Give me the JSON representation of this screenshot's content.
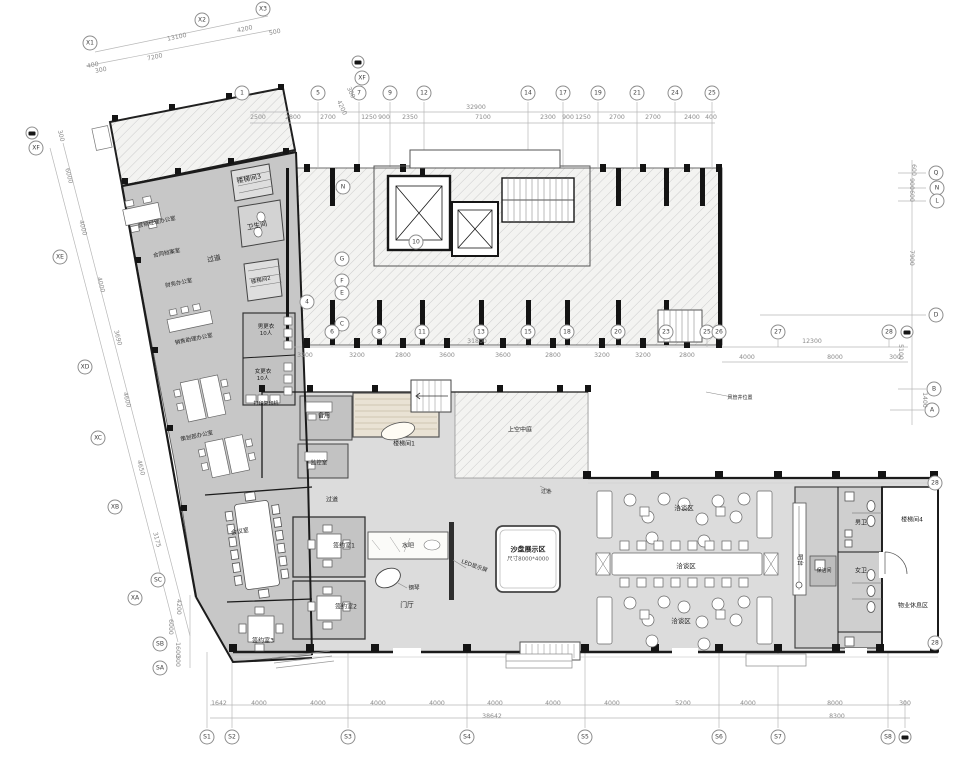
{
  "drawing_type": "architectural floor plan",
  "palette": {
    "wall": "#1b1b1b",
    "room_fill": "#c7c7c7",
    "hall_fill": "#dcdcdc",
    "hatch_line": "#bdbdbd",
    "dim_line": "#b8b8b8",
    "dim_text": "#8b8b8b",
    "label_text": "#232323"
  },
  "plan": {
    "key_labels": {
      "sandbox": "沙盘展示区",
      "sandbox_size": "尺寸8000*4000",
      "lobby": "门厅"
    },
    "grid_bubbles": [
      {
        "l": "X1",
        "x": 90,
        "y": 43
      },
      {
        "l": "X2",
        "x": 202,
        "y": 20
      },
      {
        "l": "X3",
        "x": 263,
        "y": 9
      },
      {
        "f": 1,
        "x": 358,
        "y": 62
      },
      {
        "l": "XF",
        "x": 362,
        "y": 78
      },
      {
        "l": "1",
        "x": 242,
        "y": 93
      },
      {
        "l": "5",
        "x": 318,
        "y": 93
      },
      {
        "l": "7",
        "x": 359,
        "y": 93
      },
      {
        "l": "9",
        "x": 390,
        "y": 93
      },
      {
        "l": "12",
        "x": 424,
        "y": 93
      },
      {
        "l": "14",
        "x": 528,
        "y": 93
      },
      {
        "l": "17",
        "x": 563,
        "y": 93
      },
      {
        "l": "19",
        "x": 598,
        "y": 93
      },
      {
        "l": "21",
        "x": 637,
        "y": 93
      },
      {
        "l": "24",
        "x": 675,
        "y": 93
      },
      {
        "l": "25",
        "x": 712,
        "y": 93
      },
      {
        "f": 1,
        "x": 32,
        "y": 133
      },
      {
        "l": "XF",
        "x": 36,
        "y": 148
      },
      {
        "l": "XE",
        "x": 60,
        "y": 257
      },
      {
        "l": "XD",
        "x": 85,
        "y": 367
      },
      {
        "l": "XC",
        "x": 98,
        "y": 438
      },
      {
        "l": "XB",
        "x": 115,
        "y": 507
      },
      {
        "l": "SC",
        "x": 158,
        "y": 580
      },
      {
        "l": "XA",
        "x": 135,
        "y": 598
      },
      {
        "l": "SB",
        "x": 160,
        "y": 644
      },
      {
        "l": "SA",
        "x": 160,
        "y": 668
      },
      {
        "l": "N",
        "x": 343,
        "y": 187
      },
      {
        "l": "G",
        "x": 342,
        "y": 259
      },
      {
        "l": "F",
        "x": 342,
        "y": 281
      },
      {
        "l": "E",
        "x": 342,
        "y": 293
      },
      {
        "l": "C",
        "x": 342,
        "y": 324
      },
      {
        "l": "4",
        "x": 307,
        "y": 302
      },
      {
        "l": "10",
        "x": 416,
        "y": 242
      },
      {
        "l": "6",
        "x": 332,
        "y": 332
      },
      {
        "l": "8",
        "x": 379,
        "y": 332
      },
      {
        "l": "11",
        "x": 422,
        "y": 332
      },
      {
        "l": "13",
        "x": 481,
        "y": 332
      },
      {
        "l": "15",
        "x": 528,
        "y": 332
      },
      {
        "l": "18",
        "x": 567,
        "y": 332
      },
      {
        "l": "20",
        "x": 618,
        "y": 332
      },
      {
        "l": "23",
        "x": 666,
        "y": 332
      },
      {
        "l": "25",
        "x": 707,
        "y": 332
      },
      {
        "l": "26",
        "x": 719,
        "y": 332
      },
      {
        "l": "27",
        "x": 778,
        "y": 332
      },
      {
        "l": "28",
        "x": 889,
        "y": 332
      },
      {
        "f": 1,
        "x": 907,
        "y": 332
      },
      {
        "l": "Q",
        "x": 936,
        "y": 173
      },
      {
        "l": "N",
        "x": 937,
        "y": 188
      },
      {
        "l": "L",
        "x": 937,
        "y": 201
      },
      {
        "l": "D",
        "x": 936,
        "y": 315
      },
      {
        "l": "B",
        "x": 934,
        "y": 389
      },
      {
        "l": "A",
        "x": 932,
        "y": 410
      },
      {
        "l": "28",
        "x": 935,
        "y": 483
      },
      {
        "l": "28",
        "x": 935,
        "y": 643
      },
      {
        "l": "S1",
        "x": 207,
        "y": 737
      },
      {
        "l": "S2",
        "x": 232,
        "y": 737
      },
      {
        "l": "S3",
        "x": 348,
        "y": 737
      },
      {
        "l": "S4",
        "x": 467,
        "y": 737
      },
      {
        "l": "S5",
        "x": 585,
        "y": 737
      },
      {
        "l": "S6",
        "x": 719,
        "y": 737
      },
      {
        "l": "S7",
        "x": 778,
        "y": 737
      },
      {
        "l": "S8",
        "x": 888,
        "y": 737
      },
      {
        "f": 1,
        "x": 905,
        "y": 737
      }
    ],
    "dimensions": [
      {
        "t": "7200",
        "x": 155,
        "y": 58,
        "r": -12
      },
      {
        "t": "13100",
        "x": 177,
        "y": 38,
        "r": -12
      },
      {
        "t": "4200",
        "x": 245,
        "y": 30,
        "r": -12
      },
      {
        "t": "500",
        "x": 275,
        "y": 33,
        "r": -12
      },
      {
        "t": "400",
        "x": 93,
        "y": 66,
        "r": -12
      },
      {
        "t": "300",
        "x": 101,
        "y": 71,
        "r": -12
      },
      {
        "t": "4200",
        "x": 341,
        "y": 108,
        "r": 65
      },
      {
        "t": "300",
        "x": 350,
        "y": 93,
        "r": 65
      },
      {
        "t": "32900",
        "x": 476,
        "y": 108
      },
      {
        "t": "2500",
        "x": 258,
        "y": 118
      },
      {
        "t": "2800",
        "x": 293,
        "y": 118
      },
      {
        "t": "2700",
        "x": 328,
        "y": 118
      },
      {
        "t": "1250",
        "x": 369,
        "y": 118
      },
      {
        "t": "900",
        "x": 384,
        "y": 118
      },
      {
        "t": "2350",
        "x": 410,
        "y": 118
      },
      {
        "t": "7100",
        "x": 483,
        "y": 118
      },
      {
        "t": "2300",
        "x": 548,
        "y": 118
      },
      {
        "t": "900",
        "x": 568,
        "y": 118
      },
      {
        "t": "1250",
        "x": 583,
        "y": 118
      },
      {
        "t": "2700",
        "x": 617,
        "y": 118
      },
      {
        "t": "2700",
        "x": 653,
        "y": 118
      },
      {
        "t": "2400",
        "x": 692,
        "y": 118
      },
      {
        "t": "400",
        "x": 711,
        "y": 118
      },
      {
        "t": "31800",
        "x": 477,
        "y": 342
      },
      {
        "t": "3200",
        "x": 305,
        "y": 356
      },
      {
        "t": "3200",
        "x": 357,
        "y": 356
      },
      {
        "t": "2800",
        "x": 403,
        "y": 356
      },
      {
        "t": "3600",
        "x": 447,
        "y": 356
      },
      {
        "t": "3600",
        "x": 503,
        "y": 356
      },
      {
        "t": "2800",
        "x": 553,
        "y": 356
      },
      {
        "t": "3200",
        "x": 602,
        "y": 356
      },
      {
        "t": "3200",
        "x": 643,
        "y": 356
      },
      {
        "t": "2800",
        "x": 687,
        "y": 356
      },
      {
        "t": "12300",
        "x": 812,
        "y": 342
      },
      {
        "t": "4000",
        "x": 747,
        "y": 358
      },
      {
        "t": "8000",
        "x": 835,
        "y": 358
      },
      {
        "t": "300",
        "x": 895,
        "y": 358
      },
      {
        "t": "600",
        "x": 913,
        "y": 170,
        "r": 90
      },
      {
        "t": "900",
        "x": 911,
        "y": 184,
        "r": 90
      },
      {
        "t": "600",
        "x": 911,
        "y": 196,
        "r": 90
      },
      {
        "t": "7900",
        "x": 911,
        "y": 258,
        "r": 90
      },
      {
        "t": "5100",
        "x": 900,
        "y": 352,
        "r": 90
      },
      {
        "t": "1400",
        "x": 924,
        "y": 400,
        "r": 90
      },
      {
        "t": "300",
        "x": 60,
        "y": 136,
        "r": 76
      },
      {
        "t": "6000",
        "x": 68,
        "y": 176,
        "r": 76
      },
      {
        "t": "4000",
        "x": 82,
        "y": 228,
        "r": 76
      },
      {
        "t": "4000",
        "x": 100,
        "y": 285,
        "r": 76
      },
      {
        "t": "3690",
        "x": 117,
        "y": 338,
        "r": 76
      },
      {
        "t": "4600",
        "x": 126,
        "y": 400,
        "r": 76
      },
      {
        "t": "4650",
        "x": 140,
        "y": 468,
        "r": 76
      },
      {
        "t": "3175",
        "x": 156,
        "y": 540,
        "r": 76
      },
      {
        "t": "4200",
        "x": 178,
        "y": 607,
        "r": 90
      },
      {
        "t": "6000",
        "x": 170,
        "y": 627,
        "r": 90
      },
      {
        "t": "1600",
        "x": 177,
        "y": 650,
        "r": 90
      },
      {
        "t": "300",
        "x": 177,
        "y": 661,
        "r": 90
      },
      {
        "t": "1642",
        "x": 219,
        "y": 704
      },
      {
        "t": "4000",
        "x": 259,
        "y": 704
      },
      {
        "t": "4000",
        "x": 318,
        "y": 704
      },
      {
        "t": "4000",
        "x": 378,
        "y": 704
      },
      {
        "t": "4000",
        "x": 437,
        "y": 704
      },
      {
        "t": "4000",
        "x": 495,
        "y": 704
      },
      {
        "t": "4000",
        "x": 553,
        "y": 704
      },
      {
        "t": "4000",
        "x": 612,
        "y": 704
      },
      {
        "t": "5200",
        "x": 683,
        "y": 704
      },
      {
        "t": "4000",
        "x": 748,
        "y": 704
      },
      {
        "t": "8000",
        "x": 835,
        "y": 704
      },
      {
        "t": "300",
        "x": 905,
        "y": 704
      },
      {
        "t": "38642",
        "x": 492,
        "y": 717
      },
      {
        "t": "8300",
        "x": 837,
        "y": 717
      }
    ],
    "room_labels": [
      {
        "t": "楼梯间3",
        "x": 249,
        "y": 179,
        "r": -12
      },
      {
        "t": "卫生间",
        "x": 257,
        "y": 226,
        "r": -12
      },
      {
        "t": "营销经理办公室",
        "x": 157,
        "y": 223,
        "r": -12,
        "s": 5.5
      },
      {
        "t": "合同档案室",
        "x": 167,
        "y": 254,
        "r": -12,
        "s": 5.5
      },
      {
        "t": "财务办公室",
        "x": 179,
        "y": 284,
        "r": -12,
        "s": 5.5
      },
      {
        "t": "过道",
        "x": 214,
        "y": 259,
        "r": -12
      },
      {
        "t": "楼梯间2",
        "x": 261,
        "y": 281,
        "r": -12,
        "s": 5.5
      },
      {
        "t": "销售助理办公室",
        "x": 194,
        "y": 340,
        "r": -12,
        "s": 5.5
      },
      {
        "t": "策划部办公室",
        "x": 197,
        "y": 437,
        "r": -12,
        "s": 5.5
      },
      {
        "t": "男更衣\n10人",
        "x": 266,
        "y": 331,
        "s": 5.5
      },
      {
        "t": "女更衣\n10人",
        "x": 263,
        "y": 376,
        "s": 5.5
      },
      {
        "t": "打印复印机",
        "x": 266,
        "y": 404,
        "s": 5
      },
      {
        "t": "备用",
        "x": 324,
        "y": 416,
        "s": 6
      },
      {
        "t": "监控室",
        "x": 319,
        "y": 464,
        "s": 5.5
      },
      {
        "t": "楼梯间1",
        "x": 404,
        "y": 444,
        "s": 6
      },
      {
        "t": "上空中庭",
        "x": 520,
        "y": 430,
        "s": 6
      },
      {
        "t": "过道",
        "x": 332,
        "y": 500,
        "s": 6
      },
      {
        "t": "过道",
        "x": 546,
        "y": 492,
        "s": 5
      },
      {
        "t": "签约室1",
        "x": 344,
        "y": 546,
        "s": 6
      },
      {
        "t": "签约室2",
        "x": 346,
        "y": 607,
        "s": 6
      },
      {
        "t": "会议室",
        "x": 240,
        "y": 532,
        "r": -10,
        "s": 6
      },
      {
        "t": "签约室3",
        "x": 263,
        "y": 641,
        "s": 6
      },
      {
        "t": "水吧",
        "x": 408,
        "y": 546,
        "s": 6
      },
      {
        "t": "钢琴",
        "x": 414,
        "y": 589,
        "s": 5.5
      },
      {
        "t": "LED显示屏",
        "x": 474,
        "y": 567,
        "r": 20,
        "s": 5.5
      },
      {
        "t": "洽谈区",
        "x": 684,
        "y": 508,
        "s": 6.5
      },
      {
        "t": "洽谈区",
        "x": 686,
        "y": 566,
        "s": 6.5
      },
      {
        "t": "洽谈区",
        "x": 681,
        "y": 621,
        "s": 6.5
      },
      {
        "t": "吧台",
        "x": 799,
        "y": 560,
        "r": 90,
        "s": 6
      },
      {
        "t": "保洁间",
        "x": 824,
        "y": 571,
        "s": 5
      },
      {
        "t": "男卫",
        "x": 861,
        "y": 523,
        "s": 6
      },
      {
        "t": "女卫",
        "x": 861,
        "y": 571,
        "s": 6
      },
      {
        "t": "楼梯间4",
        "x": 912,
        "y": 520,
        "s": 6
      },
      {
        "t": "物业休息区",
        "x": 913,
        "y": 606,
        "s": 6
      },
      {
        "t": "风管井位置",
        "x": 740,
        "y": 398,
        "s": 5
      }
    ]
  }
}
